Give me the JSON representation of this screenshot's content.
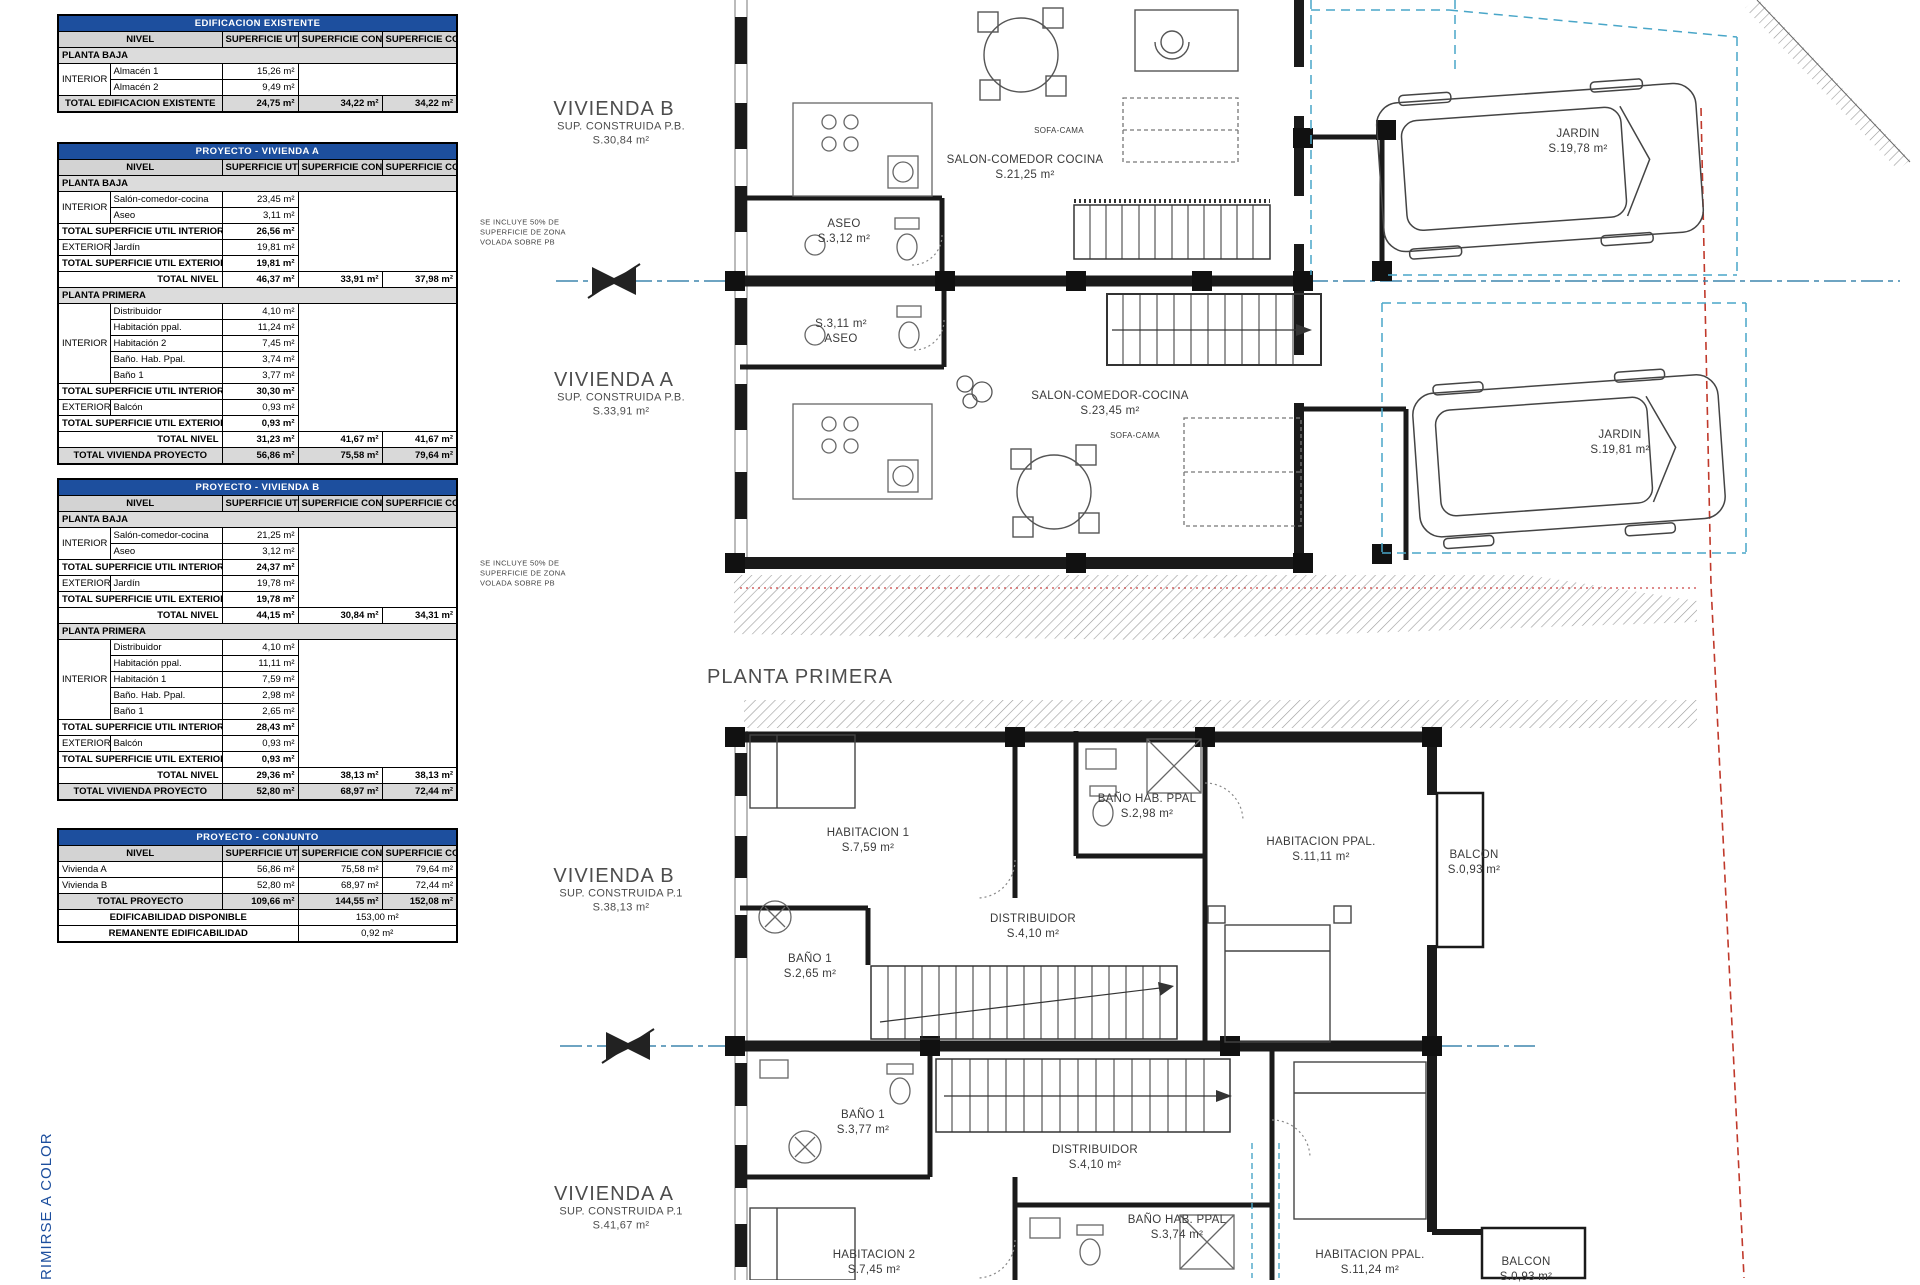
{
  "document": {
    "side_note": "RIMIRSE A COLOR"
  },
  "tables": [
    {
      "title": "EDIFICACION EXISTENTE",
      "headers": [
        "NIVEL",
        "SUPERFICIE UTIL",
        "SUPERFICIE CONSTRUIDA",
        "SUPERFICIE COMPUTABLE"
      ],
      "rows": [
        {
          "t": "sec",
          "l": "PLANTA BAJA"
        },
        {
          "t": "item",
          "cat": "INTERIOR",
          "span": 2,
          "mspan": 2,
          "name": "Almacén 1",
          "util": "15,26 m²"
        },
        {
          "t": "item",
          "name": "Almacén 2",
          "util": "9,49 m²"
        },
        {
          "t": "grand",
          "l": "TOTAL EDIFICACION EXISTENTE",
          "util": "24,75 m²",
          "cons": "34,22 m²",
          "comp": "34,22 m²"
        }
      ]
    },
    {
      "title": "PROYECTO - VIVIENDA A",
      "headers": [
        "NIVEL",
        "SUPERFICIE UTIL",
        "SUPERFICIE CONSTRUIDA",
        "SUPERFICIE COMPUTABLE"
      ],
      "rows": [
        {
          "t": "sec",
          "l": "PLANTA BAJA"
        },
        {
          "t": "item",
          "cat": "INTERIOR",
          "span": 2,
          "mspan": 5,
          "name": "Salón-comedor-cocina",
          "util": "23,45 m²"
        },
        {
          "t": "item",
          "name": "Aseo",
          "util": "3,11 m²"
        },
        {
          "t": "tot",
          "l": "TOTAL SUPERFICIE UTIL INTERIOR",
          "util": "26,56 m²"
        },
        {
          "t": "item",
          "cat": "EXTERIOR",
          "span": 1,
          "name": "Jardín",
          "util": "19,81 m²"
        },
        {
          "t": "tot",
          "l": "TOTAL SUPERFICIE UTIL EXTERIOR",
          "util": "19,81 m²"
        },
        {
          "t": "nivel",
          "l": "TOTAL NIVEL",
          "util": "46,37 m²",
          "cons": "33,91 m²",
          "comp": "37,98 m²"
        },
        {
          "t": "sec",
          "l": "PLANTA PRIMERA"
        },
        {
          "t": "item",
          "cat": "INTERIOR",
          "span": 5,
          "mspan": 8,
          "name": "Distribuidor",
          "util": "4,10 m²"
        },
        {
          "t": "item",
          "name": "Habitación ppal.",
          "util": "11,24 m²"
        },
        {
          "t": "item",
          "name": "Habitación 2",
          "util": "7,45 m²"
        },
        {
          "t": "item",
          "name": "Baño. Hab. Ppal.",
          "util": "3,74 m²"
        },
        {
          "t": "item",
          "name": "Baño 1",
          "util": "3,77 m²"
        },
        {
          "t": "tot",
          "l": "TOTAL SUPERFICIE UTIL INTERIOR",
          "util": "30,30 m²"
        },
        {
          "t": "item",
          "cat": "EXTERIOR",
          "span": 1,
          "name": "Balcón",
          "util": "0,93 m²"
        },
        {
          "t": "tot",
          "l": "TOTAL SUPERFICIE UTIL EXTERIOR",
          "util": "0,93 m²"
        },
        {
          "t": "nivel",
          "l": "TOTAL NIVEL",
          "util": "31,23 m²",
          "cons": "41,67 m²",
          "comp": "41,67 m²"
        },
        {
          "t": "grand",
          "l": "TOTAL VIVIENDA PROYECTO",
          "util": "56,86 m²",
          "cons": "75,58 m²",
          "comp": "79,64 m²"
        }
      ]
    },
    {
      "title": "PROYECTO - VIVIENDA B",
      "headers": [
        "NIVEL",
        "SUPERFICIE UTIL",
        "SUPERFICIE CONSTRUIDA",
        "SUPERFICIE COMPUTABLE"
      ],
      "rows": [
        {
          "t": "sec",
          "l": "PLANTA BAJA"
        },
        {
          "t": "item",
          "cat": "INTERIOR",
          "span": 2,
          "mspan": 5,
          "name": "Salón-comedor-cocina",
          "util": "21,25 m²"
        },
        {
          "t": "item",
          "name": "Aseo",
          "util": "3,12 m²"
        },
        {
          "t": "tot",
          "l": "TOTAL SUPERFICIE UTIL INTERIOR",
          "util": "24,37 m²"
        },
        {
          "t": "item",
          "cat": "EXTERIOR",
          "span": 1,
          "name": "Jardín",
          "util": "19,78 m²"
        },
        {
          "t": "tot",
          "l": "TOTAL SUPERFICIE UTIL EXTERIOR",
          "util": "19,78 m²"
        },
        {
          "t": "nivel",
          "l": "TOTAL NIVEL",
          "util": "44,15 m²",
          "cons": "30,84 m²",
          "comp": "34,31 m²"
        },
        {
          "t": "sec",
          "l": "PLANTA PRIMERA"
        },
        {
          "t": "item",
          "cat": "INTERIOR",
          "span": 5,
          "mspan": 8,
          "name": "Distribuidor",
          "util": "4,10 m²"
        },
        {
          "t": "item",
          "name": "Habitación ppal.",
          "util": "11,11 m²"
        },
        {
          "t": "item",
          "name": "Habitación 1",
          "util": "7,59 m²"
        },
        {
          "t": "item",
          "name": "Baño. Hab. Ppal.",
          "util": "2,98 m²"
        },
        {
          "t": "item",
          "name": "Baño 1",
          "util": "2,65 m²"
        },
        {
          "t": "tot",
          "l": "TOTAL SUPERFICIE UTIL INTERIOR",
          "util": "28,43 m²"
        },
        {
          "t": "item",
          "cat": "EXTERIOR",
          "span": 1,
          "name": "Balcón",
          "util": "0,93 m²"
        },
        {
          "t": "tot",
          "l": "TOTAL SUPERFICIE UTIL EXTERIOR",
          "util": "0,93 m²"
        },
        {
          "t": "nivel",
          "l": "TOTAL NIVEL",
          "util": "29,36 m²",
          "cons": "38,13 m²",
          "comp": "38,13 m²"
        },
        {
          "t": "grand",
          "l": "TOTAL VIVIENDA PROYECTO",
          "util": "52,80 m²",
          "cons": "68,97 m²",
          "comp": "72,44 m²"
        }
      ]
    },
    {
      "title": "PROYECTO - CONJUNTO",
      "headers": [
        "NIVEL",
        "SUPERFICIE UTIL",
        "SUPERFICIE CONSTRUIDA",
        "SUPERFICIE COMPUTABLE"
      ],
      "rows": [
        {
          "t": "plain",
          "l": "Vivienda A",
          "util": "56,86 m²",
          "cons": "75,58 m²",
          "comp": "79,64 m²"
        },
        {
          "t": "plain",
          "l": "Vivienda B",
          "util": "52,80 m²",
          "cons": "68,97 m²",
          "comp": "72,44 m²"
        },
        {
          "t": "grand",
          "l": "TOTAL PROYECTO",
          "util": "109,66 m²",
          "cons": "144,55 m²",
          "comp": "152,08 m²"
        },
        {
          "t": "span2",
          "l": "EDIFICABILIDAD DISPONIBLE",
          "val": "153,00 m²"
        },
        {
          "t": "span2",
          "l": "REMANENTE EDIFICABILIDAD",
          "val": "0,92 m²"
        }
      ]
    }
  ],
  "plan_labels": [
    {
      "t": "VIVIENDA B",
      "x": 614,
      "y": 109,
      "fs": 20,
      "c": "#4d4d4d",
      "ls": 1,
      "n": "label-vivienda-b-planta-baja"
    },
    {
      "t": "SUP. CONSTRUIDA P.B.\nS.30,84  m²",
      "x": 621,
      "y": 134,
      "fs": 11,
      "c": "#4d4d4d",
      "n": "label-sup-construida-b-pb"
    },
    {
      "t": "VIVIENDA A",
      "x": 614,
      "y": 380,
      "fs": 20,
      "c": "#4d4d4d",
      "ls": 1,
      "n": "label-vivienda-a-planta-baja"
    },
    {
      "t": "SUP. CONSTRUIDA P.B.\nS.33,91  m²",
      "x": 621,
      "y": 405,
      "fs": 11,
      "c": "#4d4d4d",
      "n": "label-sup-construida-a-pb"
    },
    {
      "t": "SALON-COMEDOR COCINA\nS.21,25  m²",
      "x": 1025,
      "y": 168,
      "fs": 11.5,
      "n": "label-salon-b"
    },
    {
      "t": "ASEO\nS.3,12  m²",
      "x": 844,
      "y": 232,
      "fs": 11.5,
      "n": "label-aseo-b"
    },
    {
      "t": "S.3,11  m²\nASEO",
      "x": 841,
      "y": 332,
      "fs": 11.5,
      "n": "label-aseo-a"
    },
    {
      "t": "SALON-COMEDOR-COCINA\nS.23,45  m²",
      "x": 1110,
      "y": 404,
      "fs": 11.5,
      "n": "label-salon-a"
    },
    {
      "t": "SOFA-CAMA",
      "x": 1059,
      "y": 131,
      "fs": 8,
      "n": "label-sofa-cama-b"
    },
    {
      "t": "SOFA-CAMA",
      "x": 1135,
      "y": 436,
      "fs": 8,
      "n": "label-sofa-cama-a"
    },
    {
      "t": "JARDIN\nS.19,78  m²",
      "x": 1578,
      "y": 142,
      "fs": 11.5,
      "n": "label-jardin-b"
    },
    {
      "t": "JARDIN\nS.19,81  m²",
      "x": 1620,
      "y": 443,
      "fs": 11.5,
      "n": "label-jardin-a"
    },
    {
      "t": "PLANTA PRIMERA",
      "x": 800,
      "y": 677,
      "fs": 20,
      "c": "#4d4d4d",
      "ls": 1,
      "n": "label-planta-primera"
    },
    {
      "t": "VIVIENDA B",
      "x": 614,
      "y": 876,
      "fs": 20,
      "c": "#4d4d4d",
      "ls": 1,
      "n": "label-vivienda-b-planta-primera"
    },
    {
      "t": "SUP. CONSTRUIDA P.1\nS.38,13  m²",
      "x": 621,
      "y": 901,
      "fs": 11,
      "c": "#4d4d4d",
      "n": "label-sup-construida-b-p1"
    },
    {
      "t": "HABITACION 1\nS.7,59  m²",
      "x": 868,
      "y": 841,
      "fs": 11.5,
      "n": "label-habitacion-1-b"
    },
    {
      "t": "BAÑO HAB. PPAL\nS.2,98  m²",
      "x": 1147,
      "y": 807,
      "fs": 11.5,
      "n": "label-bano-hab-ppal-b"
    },
    {
      "t": "HABITACION PPAL.\nS.11,11  m²",
      "x": 1321,
      "y": 850,
      "fs": 11.5,
      "n": "label-habitacion-ppal-b"
    },
    {
      "t": "BALCON\nS.0,93  m²",
      "x": 1474,
      "y": 863,
      "fs": 11.5,
      "n": "label-balcon-b"
    },
    {
      "t": "DISTRIBUIDOR\nS.4,10  m²",
      "x": 1033,
      "y": 927,
      "fs": 11.5,
      "n": "label-distribuidor-b"
    },
    {
      "t": "BAÑO 1\nS.2,65  m²",
      "x": 810,
      "y": 967,
      "fs": 11.5,
      "n": "label-bano-1-b"
    },
    {
      "t": "VIVIENDA A",
      "x": 614,
      "y": 1194,
      "fs": 20,
      "c": "#4d4d4d",
      "ls": 1,
      "n": "label-vivienda-a-planta-primera"
    },
    {
      "t": "SUP. CONSTRUIDA P.1\nS.41,67  m²",
      "x": 621,
      "y": 1219,
      "fs": 11,
      "c": "#4d4d4d",
      "n": "label-sup-construida-a-p1"
    },
    {
      "t": "BAÑO 1\nS.3,77  m²",
      "x": 863,
      "y": 1123,
      "fs": 11.5,
      "n": "label-bano-1-a"
    },
    {
      "t": "DISTRIBUIDOR\nS.4,10  m²",
      "x": 1095,
      "y": 1158,
      "fs": 11.5,
      "n": "label-distribuidor-a"
    },
    {
      "t": "HABITACION 2\nS.7,45  m²",
      "x": 874,
      "y": 1263,
      "fs": 11.5,
      "n": "label-habitacion-2-a"
    },
    {
      "t": "BAÑO HAB. PPAL\nS.3,74  m²",
      "x": 1177,
      "y": 1228,
      "fs": 11.5,
      "n": "label-bano-hab-ppal-a"
    },
    {
      "t": "HABITACION PPAL.\nS.11,24  m²",
      "x": 1370,
      "y": 1263,
      "fs": 11.5,
      "n": "label-habitacion-ppal-a"
    },
    {
      "t": "BALCON\nS.0,93  m²",
      "x": 1526,
      "y": 1270,
      "fs": 11.5,
      "n": "label-balcon-a"
    },
    {
      "t": "SE INCLUYE 50% DE\nSUPERFICIE DE ZONA\nVOLADA SOBRE PB",
      "x": 480,
      "y": 232,
      "fs": 7.5,
      "c": "#444444",
      "al": "left",
      "n": "note-voladizo-a"
    },
    {
      "t": "SE INCLUYE 50% DE\nSUPERFICIE DE ZONA\nVOLADA SOBRE PB",
      "x": 480,
      "y": 573,
      "fs": 7.5,
      "c": "#444444",
      "al": "left",
      "n": "note-voladizo-b"
    }
  ]
}
